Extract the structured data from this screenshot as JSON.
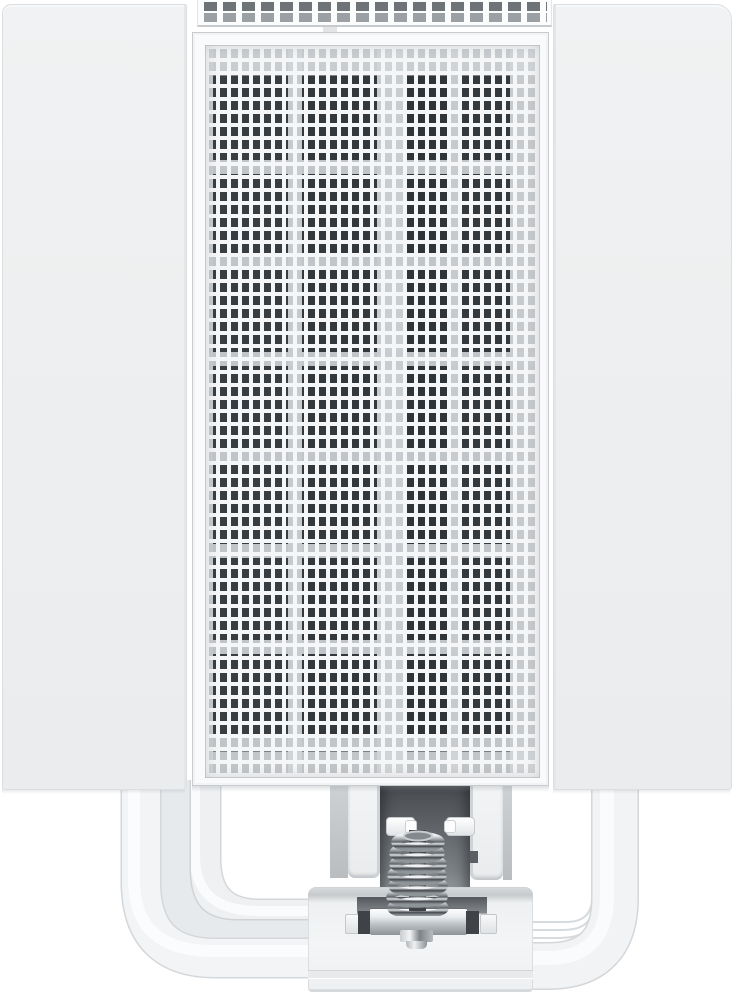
{
  "scene": {
    "type": "product-photo",
    "subject": "White tower CPU air cooler, front view, on plain white background",
    "background_color": "#ffffff",
    "text_content": "none"
  },
  "cooler": {
    "shell": {
      "color": "#edeff0",
      "left_panel": "blank white side cover",
      "right_panel": "blank white side cover"
    },
    "top_vent": {
      "rows": 2,
      "row1_square_color": "#6e7377",
      "row2_square_color": "#9ba0a4"
    },
    "front_grille": {
      "frame_color": "#f9fafb",
      "grid_line_color": "#f5f6f7",
      "hole_light_color": "#c6cacd",
      "hole_dark_color": "#33383c",
      "dark_blade_columns": 4,
      "light_separator_row_period_px": 96
    },
    "heatpipes": {
      "color": "#f2f4f5",
      "visible_left": 3,
      "visible_right": 1,
      "finish": "white powder-coated"
    },
    "mount": {
      "bracket_arm_color": "#f3f4f5",
      "recess_color": "#5d6165",
      "fan_clip_pegs": 2,
      "spring": {
        "finish": "chrome",
        "coils": 7
      },
      "crossbar_finish": "polished steel with dark notches",
      "base_block_color": "#f4f5f6"
    }
  },
  "aria": {
    "root": "Product photo of a white CPU tower cooler with mesh front grille, white heatpipes and chrome mounting spring screw",
    "left_panel": "Left white side cover panel",
    "right_panel": "Right white side cover panel",
    "top_vent": "Perforated top edge of front fan frame",
    "front_grille": "Front mesh grille with fan visible behind",
    "heatpipes": "White heatpipes curving into the base",
    "mount": "Mounting bracket recess with clip pegs",
    "spring": "Chrome spring-loaded mounting screw",
    "base": "White cooler base block with steel crossbar"
  }
}
